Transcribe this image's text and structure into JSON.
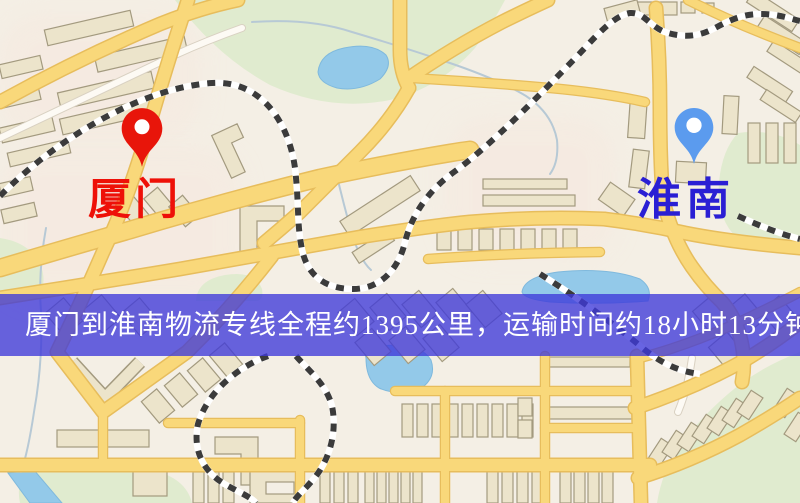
{
  "map": {
    "origin_marker": {
      "label": "厦门",
      "pin_color": "#e8150a",
      "label_color": "#ee1008"
    },
    "destination_marker": {
      "label": "淮南",
      "pin_color": "#5b9bee",
      "label_color": "#2a1fd4"
    },
    "palette": {
      "background": "#f4efe5",
      "road_fill": "#f9d87a",
      "road_casing": "#e7bd5c",
      "park": "#e0ebcf",
      "water": "#93c9e9",
      "building": "#ece4cb",
      "railway_dark": "#3b3b3b",
      "railway_light": "#ffffff"
    }
  },
  "banner": {
    "text": "厦门到淮南物流专线全程约1395公里，运输时间约18小时13分钟.",
    "text_color": "#ffffff",
    "bg_color": "rgba(62,57,218,0.78)"
  }
}
